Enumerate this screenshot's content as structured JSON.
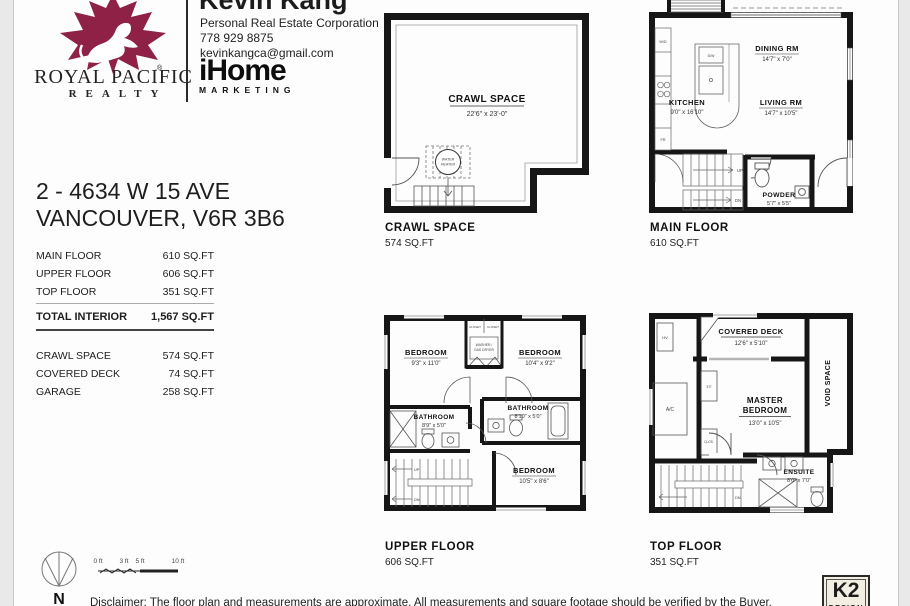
{
  "header": {
    "agent_name": "Kevin Kang",
    "agent_title": "Personal Real Estate Corporation",
    "agent_phone": "778 929 8875",
    "agent_email": "kevinkangca@gmail.com",
    "brand_line1": "ROYAL PACIFIC",
    "brand_line2": "REALTY",
    "marketing_logo": "iHome",
    "marketing_sub": "MARKETING"
  },
  "listing": {
    "address_line1": "2 - 4634 W 15 AVE",
    "address_line2": "VANCOUVER, V6R 3B6"
  },
  "area_table": {
    "rows": [
      {
        "label": "MAIN FLOOR",
        "value": "610 SQ.FT"
      },
      {
        "label": "UPPER FLOOR",
        "value": "606 SQ.FT"
      },
      {
        "label": "TOP FLOOR",
        "value": "351 SQ.FT"
      }
    ],
    "total_label": "TOTAL INTERIOR",
    "total_value": "1,567 SQ.FT",
    "extras": [
      {
        "label": "CRAWL SPACE",
        "value": "574 SQ.FT"
      },
      {
        "label": "COVERED DECK",
        "value": "74 SQ.FT"
      },
      {
        "label": "GARAGE",
        "value": "258 SQ.FT"
      }
    ]
  },
  "plans": {
    "crawl": {
      "caption": "CRAWL SPACE",
      "area": "574 SQ.FT",
      "room": "CRAWL SPACE",
      "dims": "22'6\" x 23'-0\"",
      "wh1": "WATER",
      "wh2": "HEATER"
    },
    "main": {
      "caption": "MAIN FLOOR",
      "area": "610 SQ.FT",
      "dining": "DINING RM",
      "dining_dims": "14'7\" x 7'0\"",
      "living": "LIVING RM",
      "living_dims": "14'7\" x 10'5\"",
      "kitchen": "KITCHEN",
      "kitchen_dims": "9'0\" x 16'10\"",
      "powder": "POWDER",
      "powder_dims": "5'7\" x 5'5\"",
      "up": "UP",
      "dn": "DN",
      "wd": "W/D",
      "fr": "FR",
      "dw": "D/W"
    },
    "upper": {
      "caption": "UPPER FLOOR",
      "area": "606 SQ.FT",
      "bedroom1": "BEDROOM",
      "bedroom1_dims": "9'3\" x 11'0\"",
      "bedroom2": "BEDROOM",
      "bedroom2_dims": "10'4\" x 9'2\"",
      "bedroom3": "BEDROOM",
      "bedroom3_dims": "10'5\" x 8'6\"",
      "bath1": "BATHROOM",
      "bath1_dims": "8'9\" x 5'0\"",
      "bath2": "BATHROOM",
      "bath2_dims": "8'10\" x 5'0\"",
      "closet1": "CLOSET",
      "closet2": "CLOSET",
      "washer1": "WASHER /",
      "washer2": "GAS DRYER",
      "up": "UP",
      "dn": "DN"
    },
    "top": {
      "caption": "TOP FLOOR",
      "area": "351 SQ.FT",
      "deck": "COVERED DECK",
      "deck_dims": "12'6\" x 5'10\"",
      "master1": "MASTER",
      "master2": "BEDROOM",
      "master_dims": "13'0\" x 10'5\"",
      "void_space": "VOID SPACE",
      "ensuite": "ENSUITE",
      "ensuite_dims": "8'0\" x 7'0\"",
      "hv": "HV",
      "ac": "A/C",
      "clos1": "3'0\"",
      "clos2": "CLOS.",
      "dn": "DN"
    }
  },
  "footer": {
    "north": "N",
    "scale_ticks": [
      "0 ft",
      "3 ft",
      "5 ft",
      "10 ft"
    ],
    "disclaimer": "Disclaimer: The floor plan and measurements are approximate. All measurements and square footage should be verified by the Buyer.",
    "k2_line1": "K2",
    "k2_line2": "DESIGN"
  },
  "colors": {
    "brand_red": "#8e2145",
    "wall": "#161616"
  }
}
